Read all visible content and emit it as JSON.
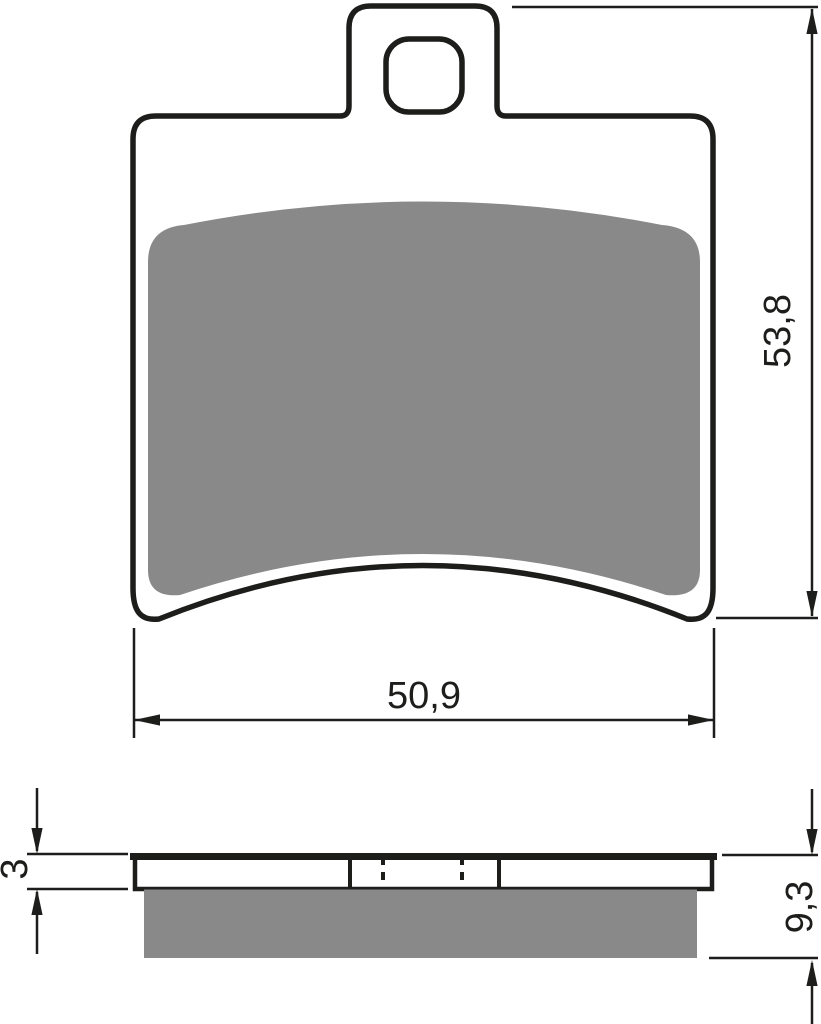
{
  "drawing": {
    "subject": "brake pad dimensional drawing, front view and side section view"
  },
  "dimensions": {
    "pad_width": "50,9",
    "pad_height": "53,8",
    "plate_thickness": "3",
    "total_thickness": "9,3"
  },
  "colors": {
    "outline": "#1d1d1b",
    "pad_gray": "#898989",
    "background": "#ffffff"
  }
}
